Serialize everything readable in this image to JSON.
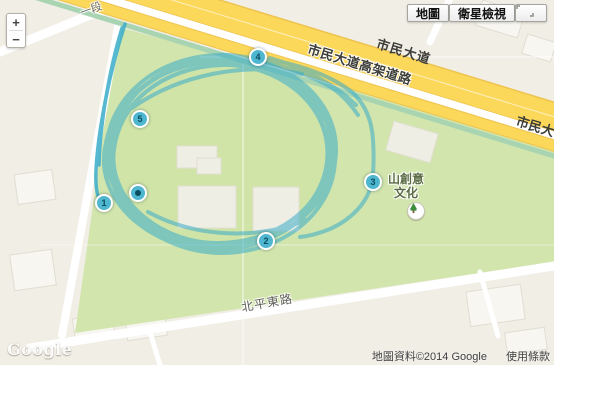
{
  "controls": {
    "zoom_in": "+",
    "zoom_out": "−",
    "map_button": "地圖",
    "satellite_button": "衛星檢視"
  },
  "labels": {
    "street_section": "一段",
    "civic_blvd": "市民大道",
    "civic_blvd_elevated": "市民大道高架道路",
    "civic_blvd_right": "市民大",
    "beiping_e_road": "北平東路",
    "poi_line1": "山創意",
    "poi_line2": "文化"
  },
  "markers": [
    "1",
    "2",
    "3",
    "4",
    "5"
  ],
  "footer": {
    "logo": "Google",
    "attribution": "地圖資料©2014 Google",
    "terms": "使用條款"
  },
  "colors": {
    "track": "#3aadca",
    "park": "#d2e5ad",
    "field": "#cfe2a3",
    "highway_fill": "#fbd75a",
    "highway_casing": "#eec44f",
    "median_strip": "#a8d4b2",
    "marker_fill": "#4fb6cf",
    "marker_text": "#0a4d61",
    "base": "#f1eee6"
  }
}
